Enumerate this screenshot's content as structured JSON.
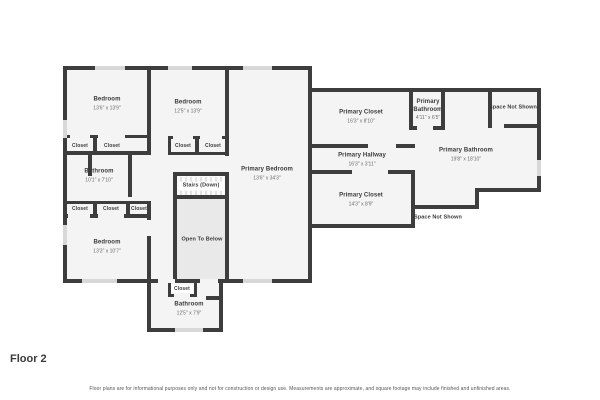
{
  "floor_label": "Floor 2",
  "disclaimer": "Floor plans are for informational purposes only and not for construction or design use. Measurements are approximate, and square footage may include finished and unfinished areas.",
  "labels": {
    "closet": "Closet",
    "stairs": "Stairs (Down)",
    "open_to_below": "Open To Below",
    "space_not_shown": "Space Not Shown"
  },
  "rooms": [
    {
      "name": "Bedroom",
      "dims": "13'6\" x 13'9\""
    },
    {
      "name": "Bedroom",
      "dims": "12'5\" x 13'9\""
    },
    {
      "name": "Bathroom",
      "dims": "10'1\" x 7'10\""
    },
    {
      "name": "Bedroom",
      "dims": "13'3\" x 10'7\""
    },
    {
      "name": "Primary Bedroom",
      "dims": "13'6\" x 34'3\""
    },
    {
      "name": "Bathroom",
      "dims": "12'5\" x 7'9\""
    },
    {
      "name": "Primary Closet",
      "dims": "16'3\" x 8'10\""
    },
    {
      "name": "Primary Bathroom",
      "dims": "4'11\" x 6'5\""
    },
    {
      "name": "Primary Hallway",
      "dims": "16'3\" x 3'11\""
    },
    {
      "name": "Primary Bathroom",
      "dims": "19'8\" x 18'10\""
    },
    {
      "name": "Primary Closet",
      "dims": "14'3\" x 8'9\""
    }
  ],
  "colors": {
    "wall": "#3d3d3d",
    "room_fill": "#f4f4f4",
    "open_to_below_fill": "#e9e9e9",
    "window": "#d8d8d8",
    "text": "#3a3a3a"
  }
}
